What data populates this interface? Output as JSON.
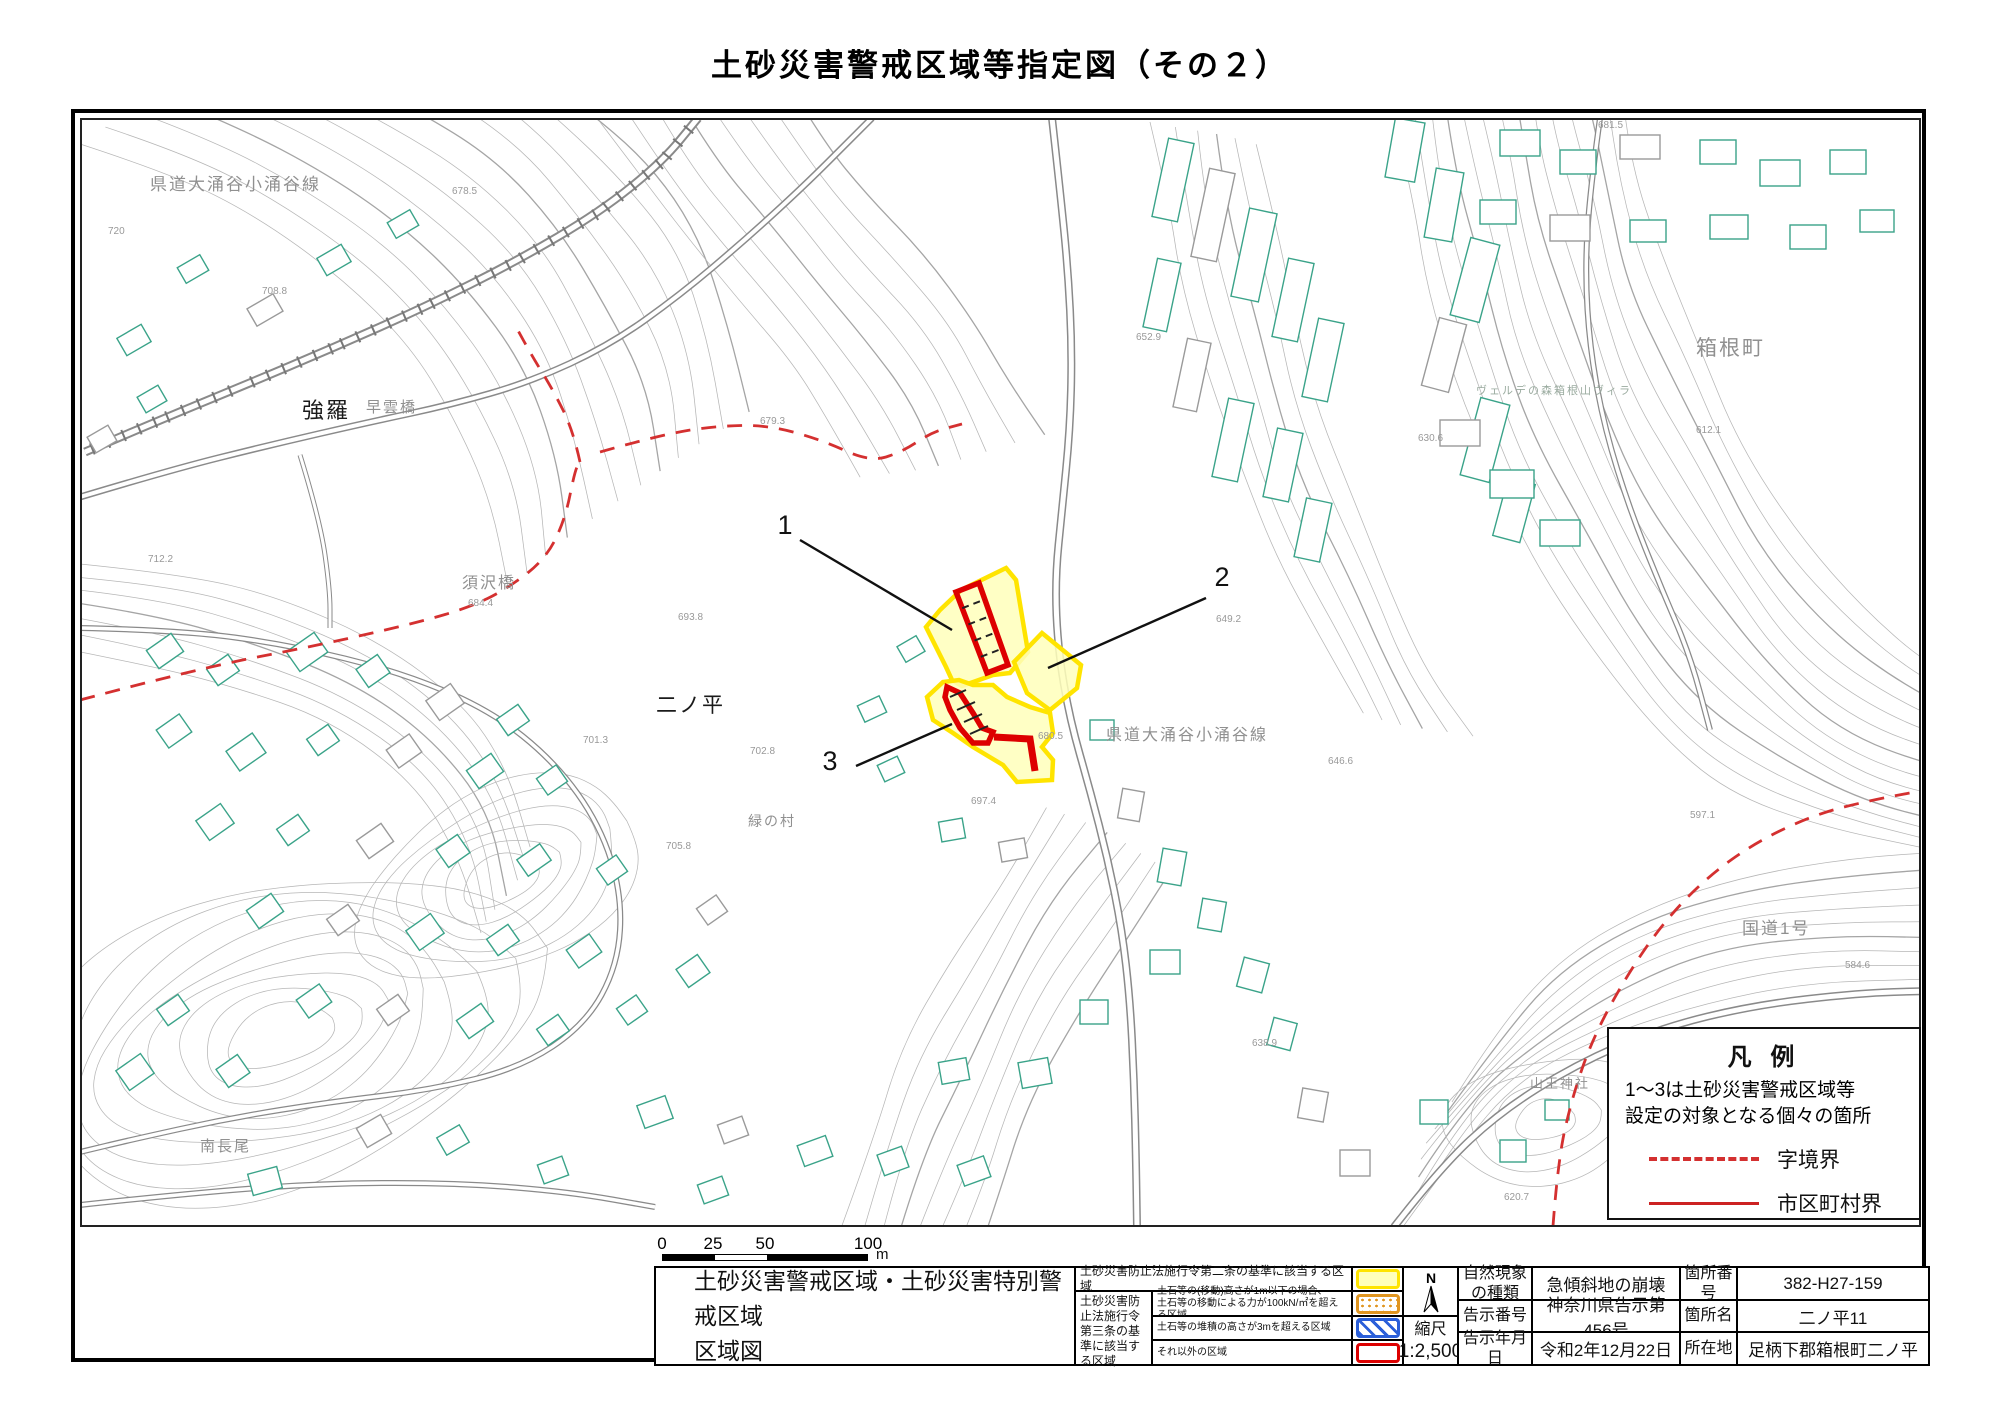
{
  "title": "土砂災害警戒区域等指定図（その２）",
  "colors": {
    "warning_border": "#ffe400",
    "warning_fill": "#ffffbb",
    "special_border": "#dd0000",
    "boundary_dash_red": "#d43030",
    "municipal_line_red": "#cc2222",
    "contour_gray": "#b6b6b6",
    "road_gray": "#8a8a8a",
    "building_teal": "#3aa389"
  },
  "legend_box": {
    "title": "凡 例",
    "note_line1": "1～3は土砂災害警戒区域等",
    "note_line2": "設定の対象となる個々の箇所",
    "items": [
      {
        "label": "字境界",
        "line": "dashed"
      },
      {
        "label": "市区町村界",
        "line": "solid"
      }
    ]
  },
  "scale_bar": {
    "ticks": [
      "0",
      "25",
      "50",
      "100"
    ],
    "unit": "m"
  },
  "bottom_table": {
    "map_title_line1": "土砂災害警戒区域・土砂災害特別警戒区域",
    "map_title_line2": "区域図",
    "law2_text": "土砂災害防止法施行令第二条の基準に該当する区域",
    "law3_label": "土砂災害防止法施行令第三条の基準に該当する区域",
    "law3_rows": [
      "土石等の(移動)高さが1m以下の場合、",
      "土石等の移動による力が100kN/㎡を超える区域",
      "土石等の堆積の高さが3mを超える区域",
      "それ以外の区域"
    ],
    "north_label": "N",
    "scale_label": "縮尺",
    "scale_value": "1:2,500",
    "info": [
      {
        "label": "自然現象の種類",
        "value": "急傾斜地の崩壊",
        "label2": "箇所番号",
        "value2": "382-H27-159"
      },
      {
        "label": "告示番号",
        "value": "神奈川県告示第456号",
        "label2": "箇所名",
        "value2": "二ノ平11"
      },
      {
        "label": "告示年月日",
        "value": "令和2年12月22日",
        "label2": "所在地",
        "value2": "足柄下郡箱根町二ノ平"
      }
    ]
  },
  "map": {
    "labels": [
      {
        "text": "県道大涌谷小涌谷線",
        "x": 150,
        "y": 190,
        "cls": "gray",
        "size": 17
      },
      {
        "text": "強羅",
        "x": 302,
        "y": 418,
        "cls": "dark",
        "size": 22
      },
      {
        "text": "早雲橋",
        "x": 366,
        "y": 412,
        "cls": "gray",
        "size": 15
      },
      {
        "text": "須沢橋",
        "x": 462,
        "y": 588,
        "cls": "gray",
        "size": 16
      },
      {
        "text": "二ノ平",
        "x": 656,
        "y": 712,
        "cls": "dark",
        "size": 21
      },
      {
        "text": "緑の村",
        "x": 748,
        "y": 826,
        "cls": "gray",
        "size": 14
      },
      {
        "text": "県道大涌谷小涌谷線",
        "x": 1106,
        "y": 740,
        "cls": "gray",
        "size": 16
      },
      {
        "text": "箱根町",
        "x": 1696,
        "y": 355,
        "cls": "gray",
        "size": 21
      },
      {
        "text": "国道1号",
        "x": 1742,
        "y": 934,
        "cls": "gray",
        "size": 17
      },
      {
        "text": "山王神社",
        "x": 1530,
        "y": 1088,
        "cls": "gray",
        "size": 13
      },
      {
        "text": "南長尾",
        "x": 200,
        "y": 1151,
        "cls": "gray",
        "size": 15
      },
      {
        "text": "ヴェルデの森箱根山ヴィラ",
        "x": 1476,
        "y": 394,
        "cls": "faint",
        "size": 11
      }
    ],
    "spot_heights": [
      {
        "text": "720",
        "x": 108,
        "y": 234
      },
      {
        "text": "712.2",
        "x": 148,
        "y": 562
      },
      {
        "text": "708.8",
        "x": 262,
        "y": 294
      },
      {
        "text": "678.5",
        "x": 452,
        "y": 194
      },
      {
        "text": "679.3",
        "x": 760,
        "y": 424
      },
      {
        "text": "684.4",
        "x": 468,
        "y": 606
      },
      {
        "text": "693.8",
        "x": 678,
        "y": 620
      },
      {
        "text": "701.3",
        "x": 583,
        "y": 743
      },
      {
        "text": "702.8",
        "x": 750,
        "y": 754
      },
      {
        "text": "705.8",
        "x": 666,
        "y": 849
      },
      {
        "text": "649.2",
        "x": 1216,
        "y": 622
      },
      {
        "text": "646.6",
        "x": 1328,
        "y": 764
      },
      {
        "text": "680.5",
        "x": 1038,
        "y": 739
      },
      {
        "text": "697.4",
        "x": 971,
        "y": 804
      },
      {
        "text": "652.9",
        "x": 1136,
        "y": 340
      },
      {
        "text": "630.6",
        "x": 1418,
        "y": 441
      },
      {
        "text": "612.1",
        "x": 1696,
        "y": 433
      },
      {
        "text": "597.1",
        "x": 1690,
        "y": 818
      },
      {
        "text": "584.6",
        "x": 1845,
        "y": 968
      },
      {
        "text": "620.7",
        "x": 1504,
        "y": 1200
      },
      {
        "text": "638.9",
        "x": 1252,
        "y": 1046
      },
      {
        "text": "681.5",
        "x": 1598,
        "y": 128
      }
    ],
    "zone_markers": [
      {
        "n": "1",
        "x": 785,
        "y": 534
      },
      {
        "n": "2",
        "x": 1222,
        "y": 586
      },
      {
        "n": "3",
        "x": 830,
        "y": 770
      }
    ]
  }
}
